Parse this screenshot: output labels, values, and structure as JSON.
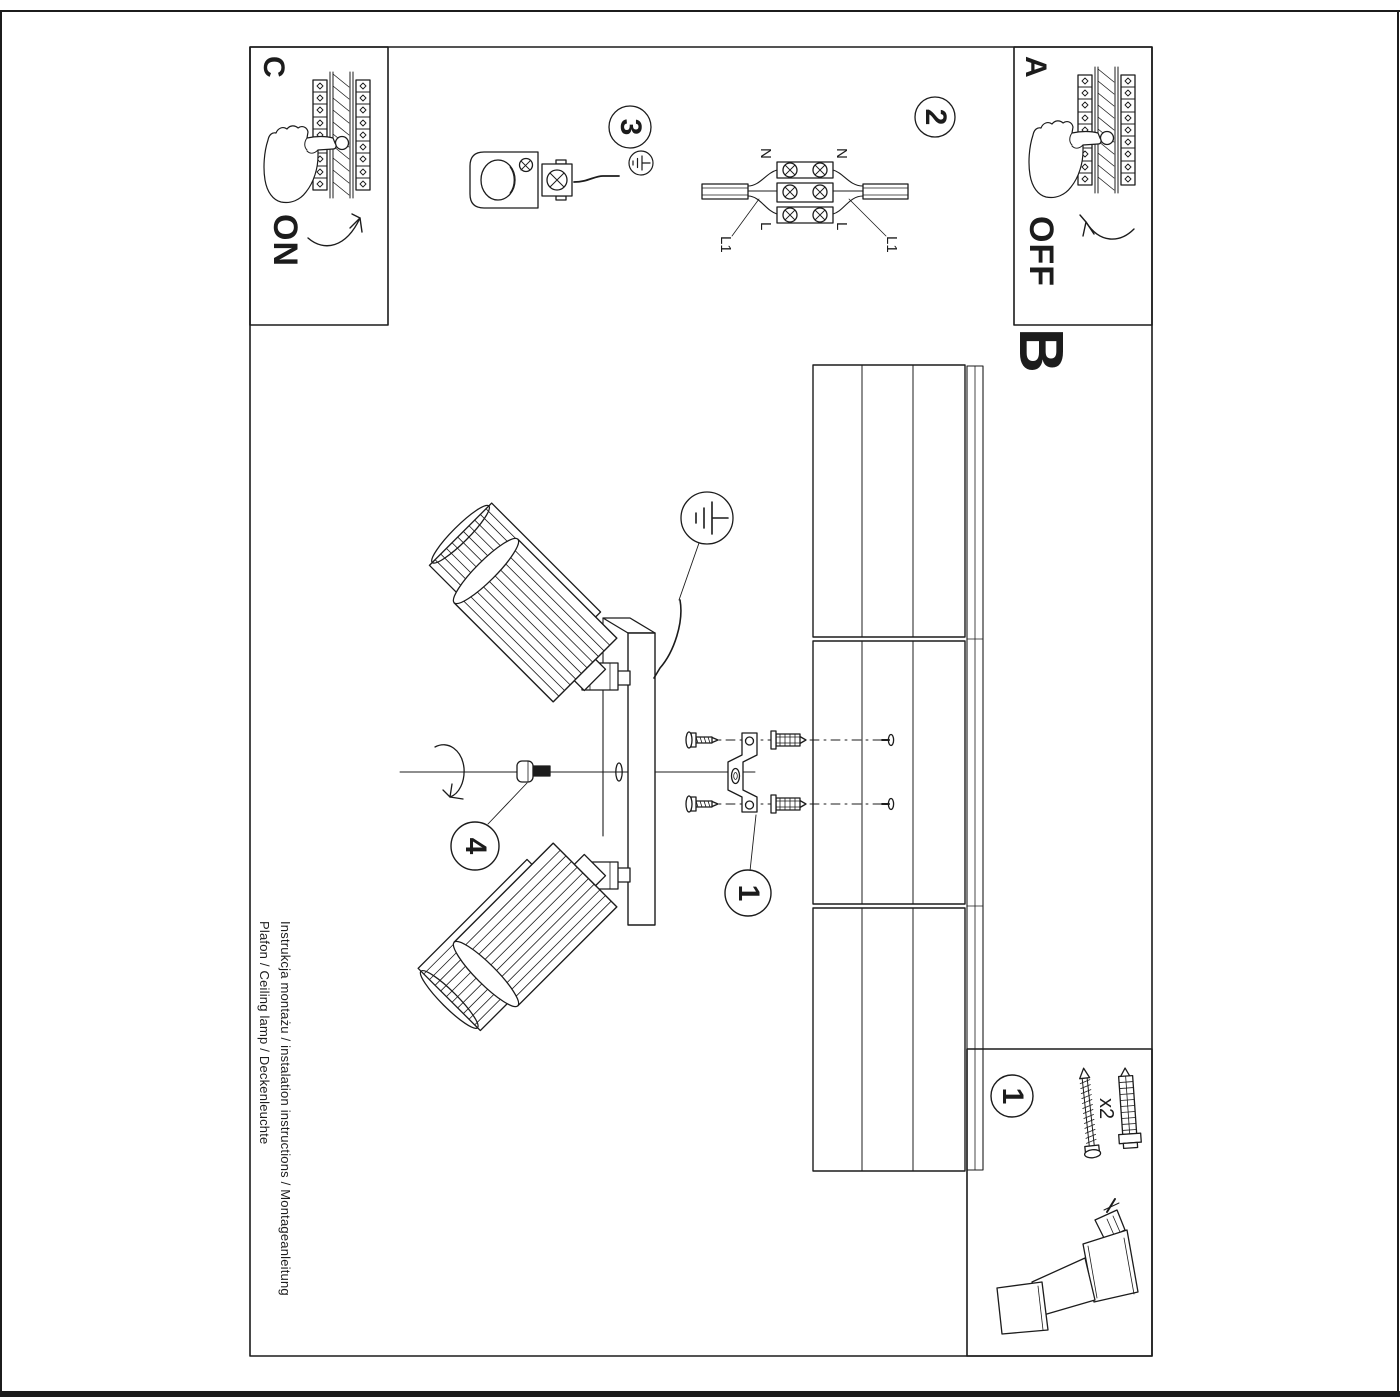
{
  "page": {
    "title_line1": "Instrukcja montażu / instalation instructions / Montageanleitung",
    "title_line2": "Plafon / Ceiling lamp / Deckenleuchte"
  },
  "section_labels": {
    "a": "A",
    "b": "B",
    "c": "C"
  },
  "power": {
    "on": "ON",
    "off": "OFF"
  },
  "step_numbers": {
    "step1": "1",
    "step2": "2",
    "step3": "3",
    "step4": "4",
    "parts_box": "1"
  },
  "wiring_labels": {
    "n_top": "N",
    "n_bottom": "N",
    "l_top": "L",
    "l_bottom": "L",
    "l1_top": "L1",
    "l1_bottom": "L1"
  },
  "hardware": {
    "quantity": "x2"
  },
  "colors": {
    "ink": "#1c1c1c",
    "paper": "#ffffff"
  }
}
